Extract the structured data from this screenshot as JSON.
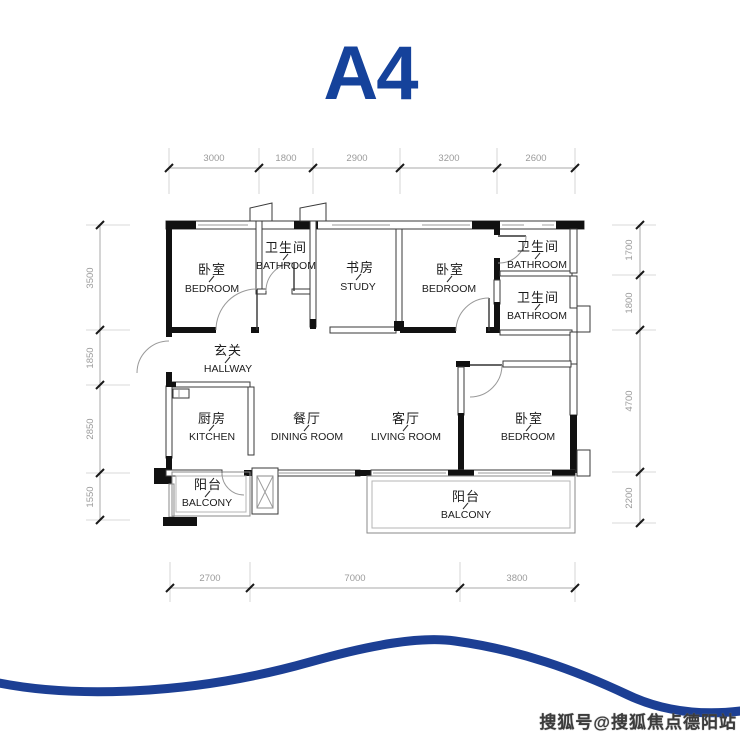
{
  "title": "A4",
  "dims": {
    "top": [
      "3000",
      "1800",
      "2900",
      "3200",
      "2600"
    ],
    "left": [
      "3500",
      "1850",
      "2850",
      "1550"
    ],
    "right": [
      "1700",
      "1800",
      "4700",
      "2200"
    ],
    "bottom": [
      "2700",
      "7000",
      "3800"
    ]
  },
  "rooms": {
    "bedroom_top_left": {
      "cn": "卧室",
      "en": "BEDROOM"
    },
    "bathroom_top": {
      "cn": "卫生间",
      "en": "BATHROOM"
    },
    "study": {
      "cn": "书房",
      "en": "STUDY"
    },
    "bedroom_top_right": {
      "cn": "卧室",
      "en": "BEDROOM"
    },
    "bathroom_right_upper": {
      "cn": "卫生间",
      "en": "BATHROOM"
    },
    "bathroom_right_lower": {
      "cn": "卫生间",
      "en": "BATHROOM"
    },
    "hallway": {
      "cn": "玄关",
      "en": "HALLWAY"
    },
    "kitchen": {
      "cn": "厨房",
      "en": "KITCHEN"
    },
    "dining": {
      "cn": "餐厅",
      "en": "DINING ROOM"
    },
    "living": {
      "cn": "客厅",
      "en": "LIVING ROOM"
    },
    "bedroom_bottom": {
      "cn": "卧室",
      "en": "BEDROOM"
    },
    "balcony_left": {
      "cn": "阳台",
      "en": "BALCONY"
    },
    "balcony_main": {
      "cn": "阳台",
      "en": "BALCONY"
    }
  },
  "watermark": "搜狐号@搜狐焦点德阳站",
  "colors": {
    "accent_blue": "#15429b",
    "wave_blue": "#1c3f94",
    "wall_black": "#111111",
    "dim_gray": "#9b9b9b",
    "watermark_gray": "#3c3c3c"
  }
}
